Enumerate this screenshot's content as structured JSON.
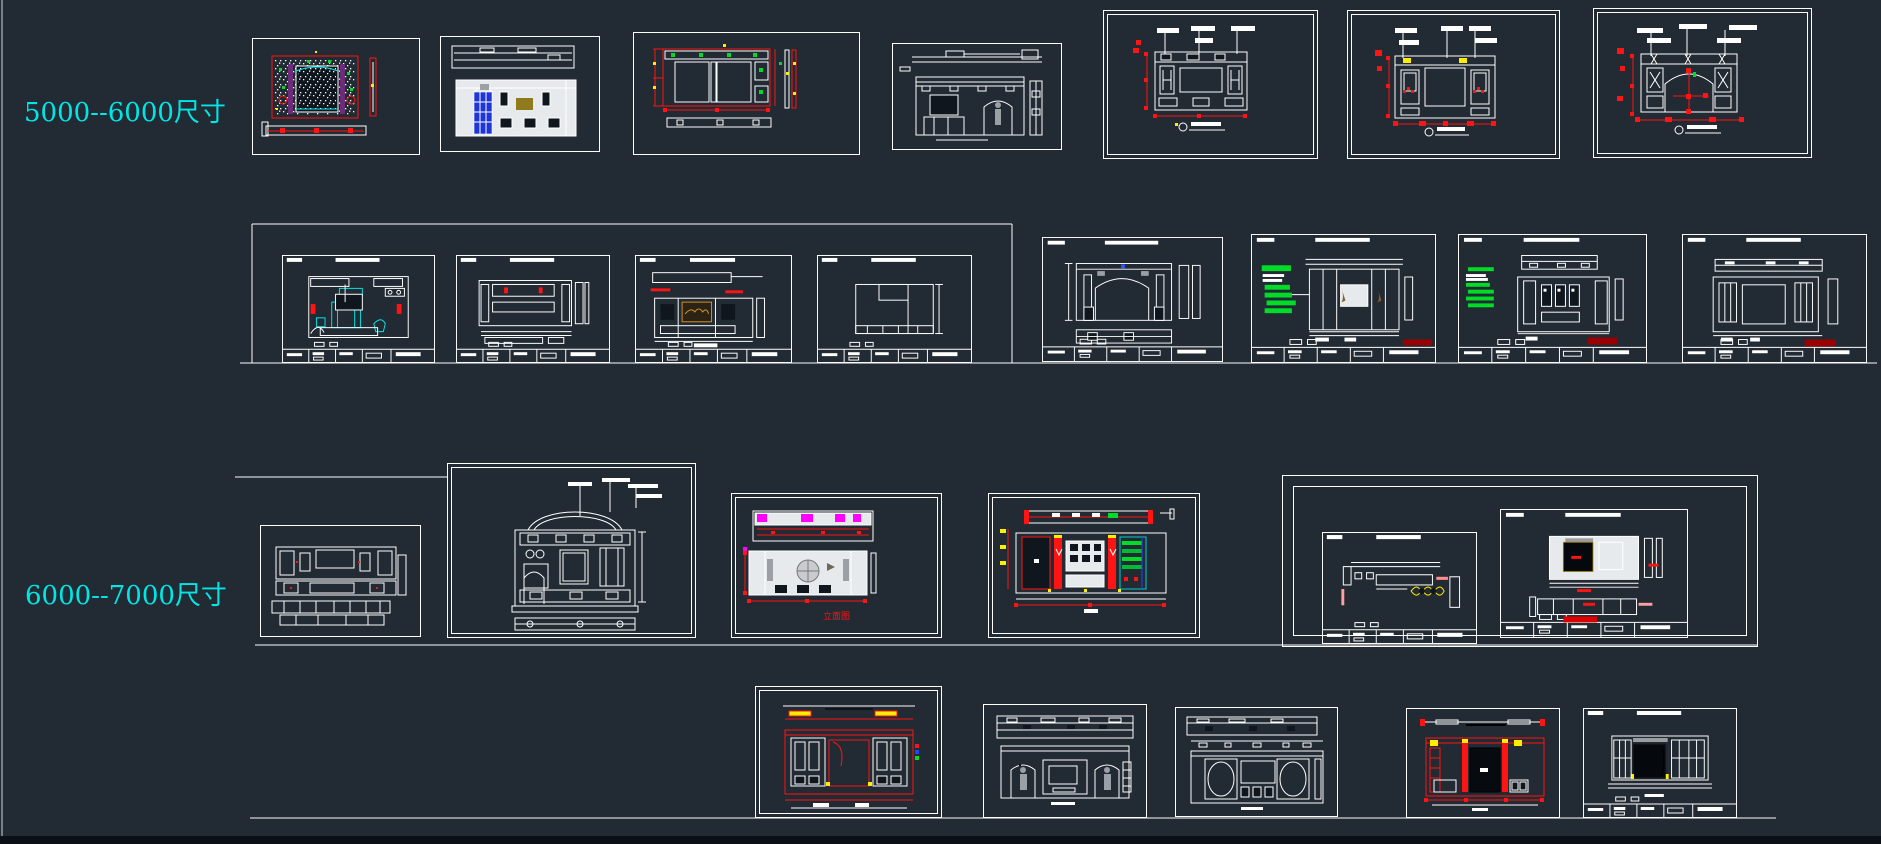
{
  "app": {
    "name": "cad-model-space",
    "description": "Dark CAD canvas with TV background wall elevation drawing collection grouped by wall size"
  },
  "palette": {
    "bg": "#222a33",
    "line": "#ffffff",
    "panel": "#e7eaec",
    "dark": "#10161d",
    "cyan": "#00e6e6",
    "red": "#ff1414",
    "darkred": "#9b0000",
    "green": "#00dc28",
    "magenta": "#ff00ff",
    "yellow": "#ffee00",
    "blue": "#1d35d9",
    "olive": "#8f7a1e",
    "orange": "#d89018",
    "purple": "#6b2d7a",
    "figure": "#9aa0a6",
    "edge": "#7a8087",
    "bottombar": "#0b1016"
  },
  "groups": [
    {
      "id": "group-5000-6000",
      "label": "5000--6000尺寸",
      "color": "#00e6e6"
    },
    {
      "id": "group-6000-7000",
      "label": "6000--7000尺寸",
      "color": "#00e6e6"
    }
  ],
  "annotations": {
    "red_caption": "立面图"
  },
  "drawings": [
    {
      "id": "r1-d1",
      "group": "5000-6000",
      "kind": "tv-wall-elevation-red-speckle"
    },
    {
      "id": "r1-d2",
      "group": "5000-6000",
      "kind": "cabinet-elevation-blue-door"
    },
    {
      "id": "r1-d3",
      "group": "5000-6000",
      "kind": "wallpaper-panel-elevation-red-dims"
    },
    {
      "id": "r1-d4",
      "group": "5000-6000",
      "kind": "arch-wall-section-with-figure"
    },
    {
      "id": "r1-d5",
      "group": "5000-6000",
      "kind": "lattice-panel-elevation-with-dims"
    },
    {
      "id": "r1-d6",
      "group": "5000-6000",
      "kind": "diamond-lattice-elevation-with-dims"
    },
    {
      "id": "r1-d7",
      "group": "5000-6000",
      "kind": "arched-opening-elevation-with-dims"
    },
    {
      "id": "r2-s1",
      "group": "5000-6000",
      "kind": "bedroom-interior-sheet-cyan-furniture"
    },
    {
      "id": "r2-s2",
      "group": "5000-6000",
      "kind": "lattice-band-elevation-sheet"
    },
    {
      "id": "r2-s3",
      "group": "5000-6000",
      "kind": "tv-picture-elevation-sheet"
    },
    {
      "id": "r2-s4",
      "group": "5000-6000",
      "kind": "outline-elevation-sheet"
    },
    {
      "id": "r2-s5",
      "group": "5000-6000",
      "kind": "arch-column-elevation-sheet"
    },
    {
      "id": "r2-s6",
      "group": "5000-6000",
      "kind": "annotated-elevation-sheet-green-notes"
    },
    {
      "id": "r2-s7",
      "group": "5000-6000",
      "kind": "annotated-elevation-sheet-green-notes-2"
    },
    {
      "id": "r2-s8",
      "group": "5000-6000",
      "kind": "diamond-lattice-elevation-sheet"
    },
    {
      "id": "r3-d1",
      "group": "6000-7000",
      "kind": "lattice-sideboard-elevation"
    },
    {
      "id": "r3-d2",
      "group": "6000-7000",
      "kind": "dome-arch-elevation"
    },
    {
      "id": "r3-d3",
      "group": "6000-7000",
      "kind": "medallion-elevation-magenta-plan"
    },
    {
      "id": "r3-d4",
      "group": "6000-7000",
      "kind": "colored-tv-wall-elevation-with-shelf"
    },
    {
      "id": "r3-s5",
      "group": "6000-7000",
      "kind": "plan-sheet-yellow-bows"
    },
    {
      "id": "r3-s6",
      "group": "6000-7000",
      "kind": "tv-wall-sheet-black-screen"
    },
    {
      "id": "r4-d1",
      "group": "6000-7000",
      "kind": "red-outline-cabinet-elevation"
    },
    {
      "id": "r4-d2",
      "group": "6000-7000",
      "kind": "double-arch-elevation-with-figures"
    },
    {
      "id": "r4-d3",
      "group": "6000-7000",
      "kind": "oval-medallion-elevation"
    },
    {
      "id": "r4-d4",
      "group": "6000-7000",
      "kind": "red-column-elevation-black-tv"
    },
    {
      "id": "r4-d5",
      "group": "6000-7000",
      "kind": "tv-wall-sheet-plain"
    }
  ]
}
